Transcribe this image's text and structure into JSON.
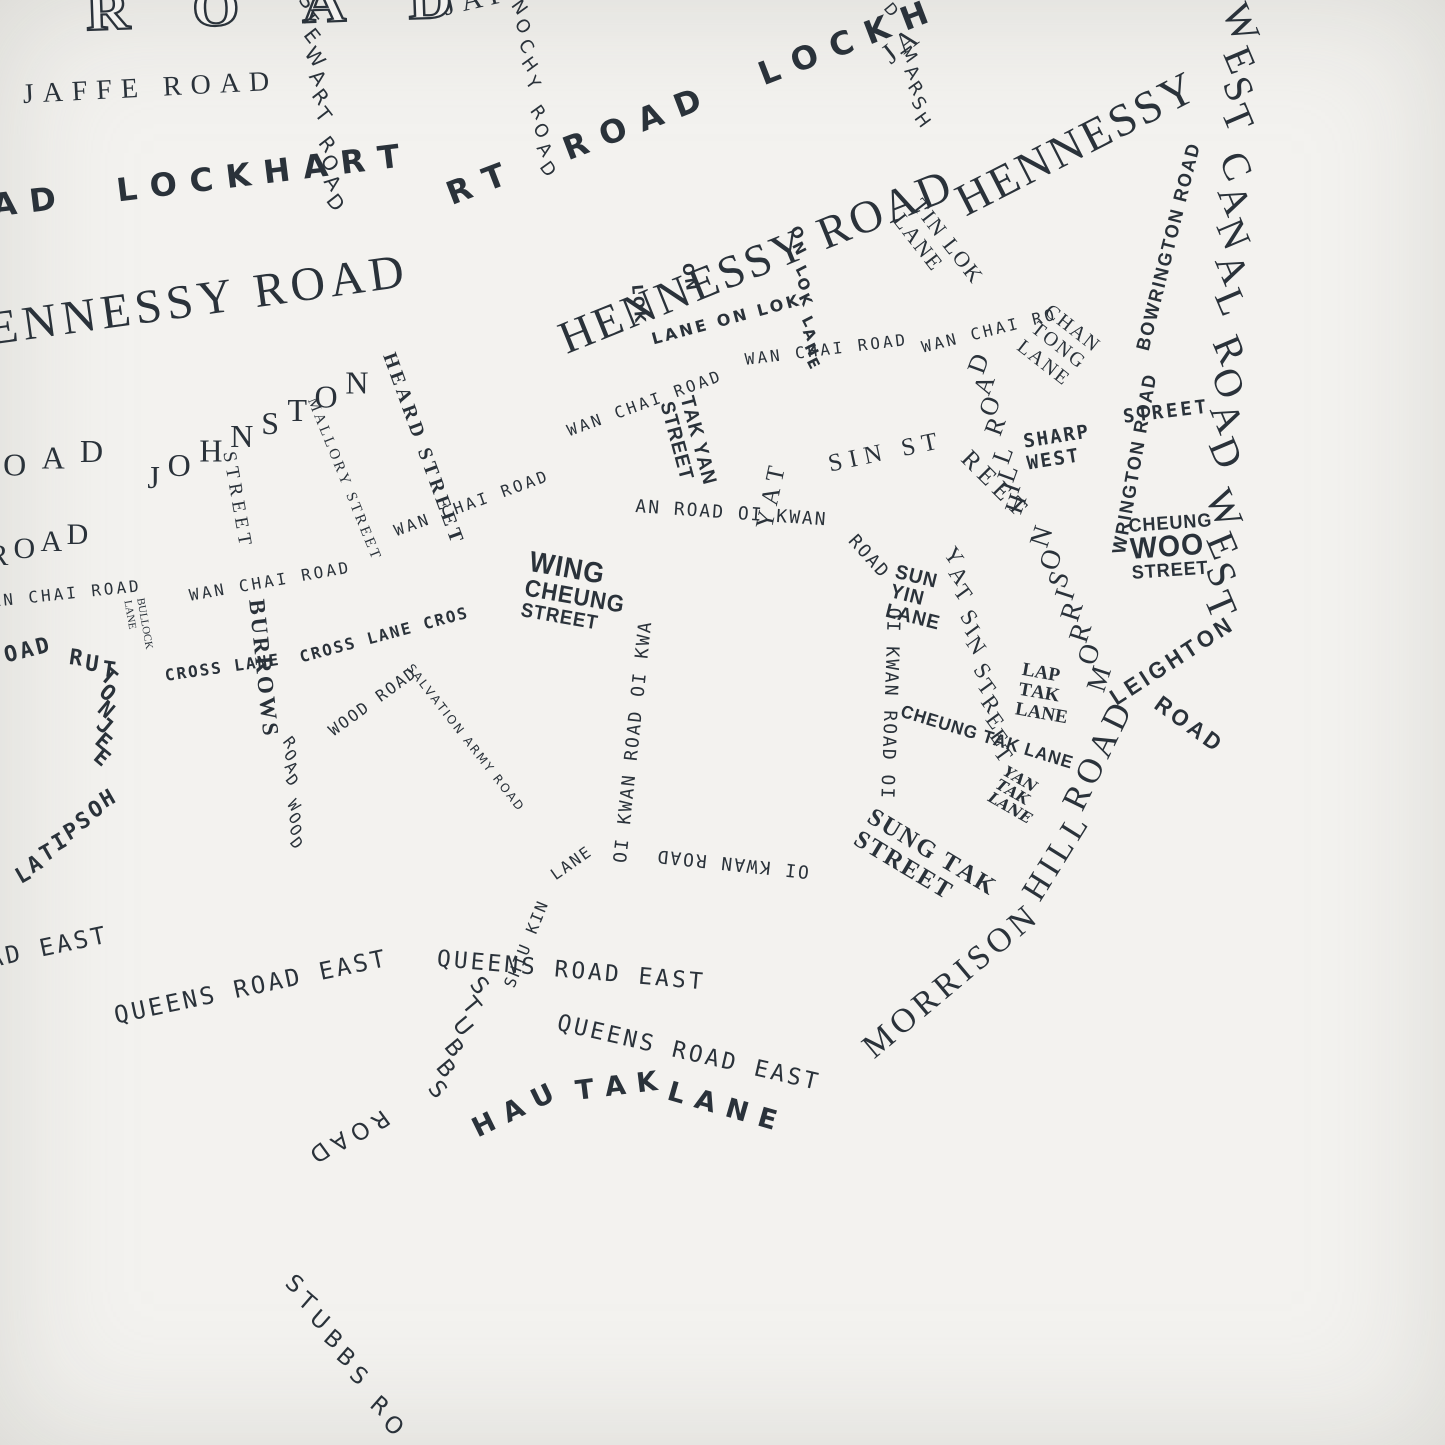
{
  "palette": {
    "paper": "#f3f2ef",
    "paper_edge": "#e7e6e3",
    "ink": "#2a323a"
  },
  "map": {
    "description_labels_note": "typographic street map of Wan Chai, streets rendered as their own names",
    "labels": [
      {
        "name": "gloucester-road-outline",
        "text": "ROAD",
        "x": 85,
        "y": -16,
        "rot": -2,
        "size": 54,
        "sp": 56,
        "font": "outline",
        "sx": 1.12
      },
      {
        "name": "jaffe-road",
        "text": "JAFFE ROAD",
        "x": 22,
        "y": 80,
        "rot": -3,
        "size": 28,
        "sp": 9,
        "font": "serif"
      },
      {
        "name": "jaffe-road",
        "text": "JAFFE RO",
        "x": 440,
        "y": -8,
        "rot": -13,
        "size": 29,
        "sp": 7,
        "font": "serif"
      },
      {
        "name": "jaffe-road",
        "text": "JA",
        "x": 876,
        "y": 46,
        "rot": -38,
        "size": 29,
        "sp": 5,
        "font": "serif"
      },
      {
        "name": "stewart-road",
        "text": "STEWART ROAD",
        "x": 318,
        "y": -6,
        "rot": 82,
        "lr": -30,
        "size": 20,
        "sp": 5,
        "font": "sans"
      },
      {
        "name": "tonnochy-road",
        "text": "NOCHY ROAD",
        "x": 528,
        "y": 0,
        "rot": 80,
        "lr": -26,
        "size": 18,
        "sp": 6,
        "font": "sans"
      },
      {
        "name": "marsh-road",
        "text": "D",
        "x": 893,
        "y": 0,
        "rot": 50,
        "size": 16,
        "sp": 2,
        "font": "sans"
      },
      {
        "name": "marsh-road",
        "text": "MARSH",
        "x": 916,
        "y": 46,
        "rot": 78,
        "lr": -24,
        "size": 18,
        "sp": 4,
        "font": "sans"
      },
      {
        "name": "lockhart-road",
        "text": "AD  LOCKHART",
        "x": -10,
        "y": 190,
        "rot": -7,
        "size": 32,
        "sp": 13,
        "font": "sansb"
      },
      {
        "name": "lockhart-road",
        "text": "RT  ROAD  LOCKH",
        "x": 442,
        "y": 180,
        "rot": -21,
        "size": 32,
        "sp": 14,
        "font": "sansb"
      },
      {
        "name": "hennessy-road",
        "text": "ENNESSY ROAD",
        "x": -15,
        "y": 305,
        "rot": -8,
        "size": 48,
        "sp": 5,
        "font": "serif"
      },
      {
        "name": "hennessy-road",
        "text": "HENNESSY ROAD",
        "x": 552,
        "y": 318,
        "rot": -22,
        "size": 46,
        "sp": 3,
        "font": "serif"
      },
      {
        "name": "hennessy-road",
        "text": "HENNESSY",
        "x": 948,
        "y": 182,
        "rot": -27,
        "size": 46,
        "sp": 3,
        "font": "serif"
      },
      {
        "name": "on-lok-lane",
        "text": "LANE ON LOK",
        "x": 650,
        "y": 332,
        "rot": -15,
        "size": 16,
        "sp": 3,
        "font": "sansb"
      },
      {
        "name": "on-lok-lane",
        "text": "ON",
        "x": 694,
        "y": 262,
        "rot": 80,
        "size": 15,
        "sp": 2,
        "font": "sansb"
      },
      {
        "name": "on-lok-lane",
        "text": "LOK",
        "x": 644,
        "y": 284,
        "rot": 85,
        "size": 15,
        "sp": 2,
        "font": "sansb"
      },
      {
        "name": "on-lok-lane",
        "text": "ON LOK LANE",
        "x": 804,
        "y": 226,
        "rot": 83,
        "lr": -20,
        "size": 15,
        "sp": 3,
        "font": "sansb"
      },
      {
        "name": "tin-lok-lane",
        "lines": [
          "TIN LOK",
          "LANE"
        ],
        "x": 926,
        "y": 194,
        "rot": 52,
        "size": 22,
        "sp": 2,
        "font": "serif",
        "lh": 1.08
      },
      {
        "name": "wan-chai-road",
        "text": "AN CHAI ROAD",
        "x": -10,
        "y": 594,
        "rot": -6,
        "size": 16,
        "sp": 3,
        "font": "hand"
      },
      {
        "name": "wan-chai-road",
        "text": "WAN CHAI ROAD",
        "x": 188,
        "y": 588,
        "rot": -10,
        "size": 16,
        "sp": 3,
        "font": "hand"
      },
      {
        "name": "wan-chai-road",
        "text": "WAN CHAI ROAD",
        "x": 392,
        "y": 524,
        "rot": -20,
        "size": 16,
        "sp": 3,
        "font": "hand"
      },
      {
        "name": "wan-chai-road",
        "text": "WAN CHAI ROAD",
        "x": 565,
        "y": 424,
        "rot": -20,
        "size": 16,
        "sp": 3,
        "font": "hand"
      },
      {
        "name": "wan-chai-road",
        "text": "WAN CHAI ROAD",
        "x": 744,
        "y": 352,
        "rot": -7,
        "size": 16,
        "sp": 3,
        "font": "hand"
      },
      {
        "name": "wan-chai-road",
        "text": "WAN CHAI RO",
        "x": 920,
        "y": 340,
        "rot": -14,
        "size": 16,
        "sp": 3,
        "font": "hand"
      },
      {
        "name": "johnston-road",
        "text": "OAD",
        "x": 0,
        "y": 452,
        "rot": -10,
        "lr": 10,
        "size": 32,
        "sp": 16,
        "font": "serif"
      },
      {
        "name": "johnston-road",
        "text": "JOHNSTON",
        "x": 140,
        "y": 468,
        "rot": -25,
        "lr": 25,
        "size": 32,
        "sp": 11,
        "font": "serif"
      },
      {
        "name": "johnston-road",
        "text": "ROAD",
        "x": -16,
        "y": 544,
        "rot": -15,
        "lr": 15,
        "size": 30,
        "sp": 6,
        "font": "serif"
      },
      {
        "name": "mallory-street",
        "text": "MALLORY STREET",
        "x": 318,
        "y": 396,
        "rot": 68,
        "size": 15,
        "sp": 3,
        "font": "serif"
      },
      {
        "name": "heard-street",
        "text": "HEARD STREET",
        "x": 398,
        "y": 350,
        "rot": 70,
        "size": 20,
        "sp": 4,
        "font": "serifb"
      },
      {
        "name": "burrows-street",
        "text": "STREET",
        "x": 238,
        "y": 450,
        "rot": 80,
        "size": 19,
        "sp": 5,
        "font": "serif"
      },
      {
        "name": "burrows-street",
        "text": "BURROWS",
        "x": 268,
        "y": 598,
        "rot": 84,
        "size": 23,
        "sp": 3,
        "font": "serifb"
      },
      {
        "name": "cross-lane",
        "text": "CROSS LANE",
        "x": 164,
        "y": 668,
        "rot": -8,
        "size": 16,
        "sp": 2,
        "font": "handb"
      },
      {
        "name": "cross-lane",
        "text": "CROSS LANE CROS",
        "x": 298,
        "y": 650,
        "rot": -15,
        "size": 16,
        "sp": 2,
        "font": "handb"
      },
      {
        "name": "bullock-lane",
        "lines": [
          "BULLOCK",
          "LANE"
        ],
        "x": 146,
        "y": 597,
        "rot": 80,
        "size": 11,
        "font": "serif",
        "lh": 1.15
      },
      {
        "name": "ruttonjee-hospital-road",
        "text": "OAD",
        "x": 2,
        "y": 646,
        "rot": -14,
        "size": 22,
        "sp": 3,
        "font": "handb"
      },
      {
        "name": "ruttonjee-hospital-road",
        "text": "RUT",
        "x": 74,
        "y": 646,
        "rot": 20,
        "lr": -12,
        "size": 22,
        "sp": 4,
        "font": "handb"
      },
      {
        "name": "ruttonjee-hospital-road",
        "text": "TONJEE",
        "x": 122,
        "y": 674,
        "rot": 95,
        "lr": -55,
        "size": 22,
        "sp": 3,
        "font": "handb"
      },
      {
        "name": "ruttonjee-hospital-road",
        "text": "HOSPITAL",
        "x": 126,
        "y": 806,
        "rot": 138,
        "lr": -168,
        "size": 22,
        "sp": 3,
        "font": "handb"
      },
      {
        "name": "ruttonjee-hospital-road",
        "text": "ROAD",
        "x": -2,
        "y": 966,
        "rot": 105,
        "lr": -20,
        "size": 20,
        "sp": 2,
        "font": "handb"
      },
      {
        "name": "wood-road",
        "text": "WOOD ROAD",
        "x": 326,
        "y": 726,
        "rot": -36,
        "size": 16,
        "sp": 2,
        "font": "hand"
      },
      {
        "name": "wood-road",
        "text": "ROAD WOOD",
        "x": 298,
        "y": 738,
        "rot": 86,
        "lr": -34,
        "size": 16,
        "sp": 3,
        "font": "hand"
      },
      {
        "name": "salvation-army-road",
        "text": "SALVATION ARMY ROAD",
        "x": 414,
        "y": 662,
        "rot": 52,
        "size": 12,
        "sp": 2,
        "font": "sans"
      },
      {
        "name": "shiu-kin-lane",
        "text": "SHIU KIN",
        "x": 502,
        "y": 984,
        "rot": -68,
        "size": 16,
        "sp": 2,
        "font": "hand"
      },
      {
        "name": "shiu-kin-lane",
        "text": "LANE",
        "x": 548,
        "y": 870,
        "rot": -35,
        "size": 16,
        "sp": 2,
        "font": "hand"
      },
      {
        "name": "queens-road-east",
        "text": "AD EAST",
        "x": -14,
        "y": 948,
        "rot": -12,
        "size": 24,
        "sp": 3,
        "font": "hand"
      },
      {
        "name": "queens-road-east",
        "text": "QUEENS ROAD EAST",
        "x": 112,
        "y": 1004,
        "rot": -12,
        "size": 24,
        "sp": 3,
        "font": "hand"
      },
      {
        "name": "queens-road-east",
        "text": "QUEENS ROAD EAST",
        "x": 438,
        "y": 948,
        "rot": 5,
        "size": 23,
        "sp": 3,
        "font": "hand"
      },
      {
        "name": "queens-road-east",
        "text": "QUEENS ROAD EAST",
        "x": 560,
        "y": 1012,
        "rot": 13,
        "size": 23,
        "sp": 3,
        "font": "hand"
      },
      {
        "name": "stubbs-road",
        "text": "STUBBS",
        "x": 496,
        "y": 986,
        "rot": 112,
        "lr": -62,
        "size": 23,
        "sp": 7,
        "font": "sans"
      },
      {
        "name": "stubbs-road",
        "text": "ROAD",
        "x": 392,
        "y": 1126,
        "rot": 152,
        "lr": -8,
        "size": 23,
        "sp": 6,
        "font": "sans"
      },
      {
        "name": "stubbs-road",
        "text": "STUBBS RO",
        "x": 300,
        "y": 1272,
        "rot": 55,
        "lr": -14,
        "size": 23,
        "sp": 7,
        "font": "sans"
      },
      {
        "name": "hau-tak-lane",
        "text": "HAU",
        "x": 468,
        "y": 1118,
        "rot": -26,
        "size": 27,
        "sp": 11,
        "font": "sansb"
      },
      {
        "name": "hau-tak-lane",
        "text": "TAK",
        "x": 574,
        "y": 1078,
        "rot": -7,
        "size": 27,
        "sp": 11,
        "font": "sansb"
      },
      {
        "name": "hau-tak-lane",
        "text": "LANE",
        "x": 672,
        "y": 1078,
        "rot": 16,
        "size": 27,
        "sp": 11,
        "font": "sansb"
      },
      {
        "name": "oi-kwan-road",
        "text": "OI KWAN ROAD OI KWA",
        "x": 612,
        "y": 862,
        "rot": -84,
        "size": 18,
        "sp": 2,
        "font": "hand"
      },
      {
        "name": "oi-kwan-road",
        "text": "AN ROAD OI KWAN",
        "x": 636,
        "y": 498,
        "rot": 4,
        "size": 18,
        "sp": 2,
        "font": "hand"
      },
      {
        "name": "oi-kwan-road",
        "text": "ROAD",
        "x": 858,
        "y": 532,
        "rot": 48,
        "size": 18,
        "sp": 2,
        "font": "hand"
      },
      {
        "name": "oi-kwan-road",
        "text": "OI KWAN ROAD OI",
        "x": 902,
        "y": 608,
        "rot": 92,
        "size": 18,
        "sp": 2,
        "font": "hand"
      },
      {
        "name": "oi-kwan-road",
        "text": "OI KWAN ROAD",
        "x": 808,
        "y": 880,
        "rot": 186,
        "size": 18,
        "sp": 2,
        "font": "hand"
      },
      {
        "name": "wing-cheung-street",
        "lines": [
          "WING",
          "CHEUNG",
          "STREET"
        ],
        "lineSizes": [
          29,
          24,
          20
        ],
        "x": 532,
        "y": 548,
        "rot": 10,
        "size": 24,
        "sp": 1,
        "font": "condb",
        "sx": 0.92,
        "lh": 1.0
      },
      {
        "name": "tak-yan-street",
        "lines": [
          "TAK YAN",
          "STREET"
        ],
        "x": 696,
        "y": 394,
        "rot": 75,
        "size": 20,
        "sp": 1,
        "font": "condb",
        "sx": 0.95,
        "lh": 1.05
      },
      {
        "name": "yat-sin-street",
        "text": "YAT",
        "x": 752,
        "y": 526,
        "rot": -78,
        "size": 25,
        "sp": 6,
        "font": "serif"
      },
      {
        "name": "yat-sin-street",
        "text": "SIN ST",
        "x": 826,
        "y": 452,
        "rot": -12,
        "size": 25,
        "sp": 7,
        "font": "serif"
      },
      {
        "name": "yat-sin-street",
        "text": "REET",
        "x": 974,
        "y": 446,
        "rot": 45,
        "size": 25,
        "sp": 6,
        "font": "serif"
      },
      {
        "name": "yat-sin-street",
        "text": "YAT SIN STREET",
        "x": 964,
        "y": 546,
        "rot": 76,
        "lr": -22,
        "size": 23,
        "sp": 3,
        "font": "serif"
      },
      {
        "name": "sun-yin-lane",
        "lines": [
          "SUN",
          "YIN",
          "LANE"
        ],
        "x": 898,
        "y": 562,
        "rot": 14,
        "size": 20,
        "sp": 1,
        "font": "condb",
        "sx": 0.95,
        "lh": 1.0
      },
      {
        "name": "morrison-hill-road",
        "text": "MORRISON",
        "x": 856,
        "y": 1038,
        "rot": -40,
        "size": 34,
        "sp": 5,
        "font": "serif"
      },
      {
        "name": "morrison-hill-road",
        "text": "HILL",
        "x": 1016,
        "y": 888,
        "rot": -58,
        "size": 34,
        "sp": 5,
        "font": "serif"
      },
      {
        "name": "morrison-hill-road",
        "text": "ROAD",
        "x": 1056,
        "y": 800,
        "rot": -64,
        "size": 35,
        "sp": 5,
        "font": "serif"
      },
      {
        "name": "morrison-hill-road",
        "text": "MORRISON",
        "x": 1092,
        "y": 698,
        "rot": -112,
        "lr": 40,
        "size": 28,
        "sp": 4,
        "font": "serif"
      },
      {
        "name": "morrison-hill-road",
        "text": "HILL ROAD",
        "x": 1006,
        "y": 518,
        "rot": -105,
        "lr": 35,
        "size": 26,
        "sp": 3,
        "font": "serif"
      },
      {
        "name": "lap-tak-lane",
        "lines": [
          "LAP",
          "TAK",
          "LANE"
        ],
        "x": 1024,
        "y": 660,
        "rot": 10,
        "size": 19,
        "font": "serifb",
        "lh": 1.06
      },
      {
        "name": "cheung-tak-lane",
        "text": "CHEUNG TAK LANE",
        "x": 904,
        "y": 702,
        "rot": 17,
        "size": 18,
        "sp": 1,
        "font": "condb",
        "sx": 0.95
      },
      {
        "name": "yan-tak-lane",
        "lines": [
          "YAN",
          "TAK",
          "LANE"
        ],
        "x": 1008,
        "y": 764,
        "rot": 30,
        "size": 15,
        "font": "script",
        "lh": 1.0
      },
      {
        "name": "sung-tak-street",
        "lines": [
          "SUNG TAK",
          "STREET"
        ],
        "x": 876,
        "y": 804,
        "rot": 31,
        "size": 25,
        "sp": 2,
        "font": "serifb",
        "lh": 1.05
      },
      {
        "name": "leighton-road",
        "text": "LEIGHTON",
        "x": 1106,
        "y": 690,
        "rot": -33,
        "size": 23,
        "sp": 4,
        "font": "condb",
        "sx": 0.95
      },
      {
        "name": "leighton-road",
        "text": "ROAD",
        "x": 1164,
        "y": 692,
        "rot": 36,
        "size": 23,
        "sp": 4,
        "font": "condb",
        "sx": 0.95
      },
      {
        "name": "bowrington-road",
        "text": "WRINGTON ROAD",
        "x": 1110,
        "y": 552,
        "rot": -80,
        "size": 19,
        "sp": 2,
        "font": "condb",
        "sx": 0.95
      },
      {
        "name": "bowrington-road",
        "text": "BOWRINGTON ROAD",
        "x": 1134,
        "y": 348,
        "rot": -76,
        "size": 19,
        "sp": 2,
        "font": "condb",
        "sx": 0.95
      },
      {
        "name": "sharp-street-west",
        "lines": [
          "SHARP",
          "WEST"
        ],
        "x": 1022,
        "y": 432,
        "rot": -9,
        "size": 19,
        "sp": 2,
        "font": "handb",
        "lh": 1.15
      },
      {
        "name": "sharp-street-west",
        "text": "STREET",
        "x": 1122,
        "y": 408,
        "rot": -7,
        "size": 19,
        "sp": 3,
        "font": "handb"
      },
      {
        "name": "chan-tong-lane",
        "lines": [
          "CHAN",
          "TONG",
          "LANE"
        ],
        "x": 1054,
        "y": 300,
        "rot": 38,
        "size": 20,
        "sp": 2,
        "font": "serif",
        "lh": 1.12
      },
      {
        "name": "cheung-woo-street",
        "lines": [
          "CHEUNG",
          "WOO",
          "STREET"
        ],
        "lineSizes": [
          19,
          30,
          19
        ],
        "x": 1128,
        "y": 518,
        "rot": -4,
        "size": 20,
        "sp": 1,
        "font": "condb",
        "sx": 0.95,
        "lh": 0.95
      },
      {
        "name": "canal-road-west",
        "text": "WEST CANAL ROAD WEST",
        "x": 1264,
        "y": 6,
        "rot": 92,
        "lr": -25,
        "size": 40,
        "sp": 6,
        "font": "serif"
      }
    ]
  }
}
